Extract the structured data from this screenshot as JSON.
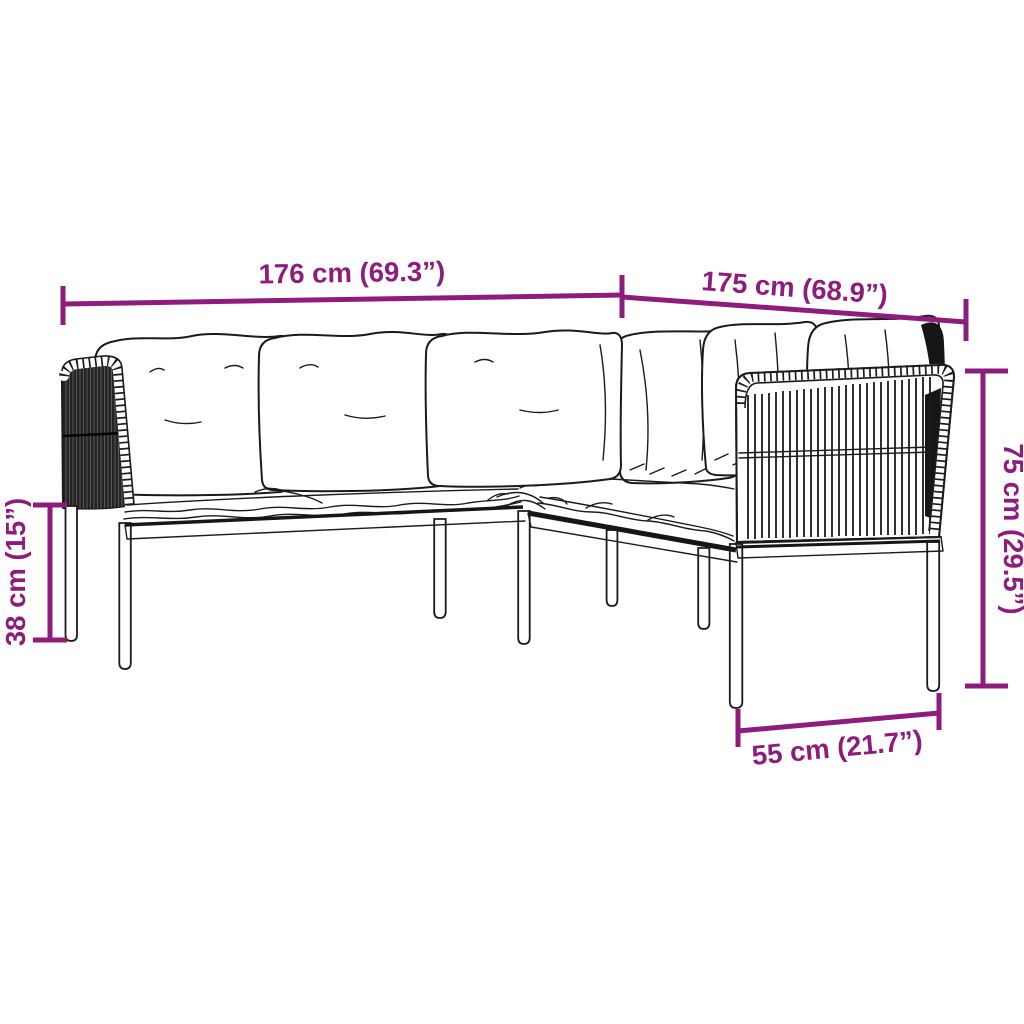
{
  "diagram": {
    "subject": "corner-sofa-dimension-diagram",
    "dimensions": {
      "width_left": {
        "label": "176 cm (69.3”)"
      },
      "width_right": {
        "label": "175 cm (68.9”)"
      },
      "seat_height": {
        "label": "38 cm (15”)"
      },
      "back_height": {
        "label": "75 cm (29.5”)"
      },
      "seat_depth": {
        "label": "55 cm (21.7”)"
      }
    }
  },
  "colors": {
    "dimension": "#8E1C7D",
    "line_art": "#1b1b1b",
    "background": "#ffffff"
  }
}
